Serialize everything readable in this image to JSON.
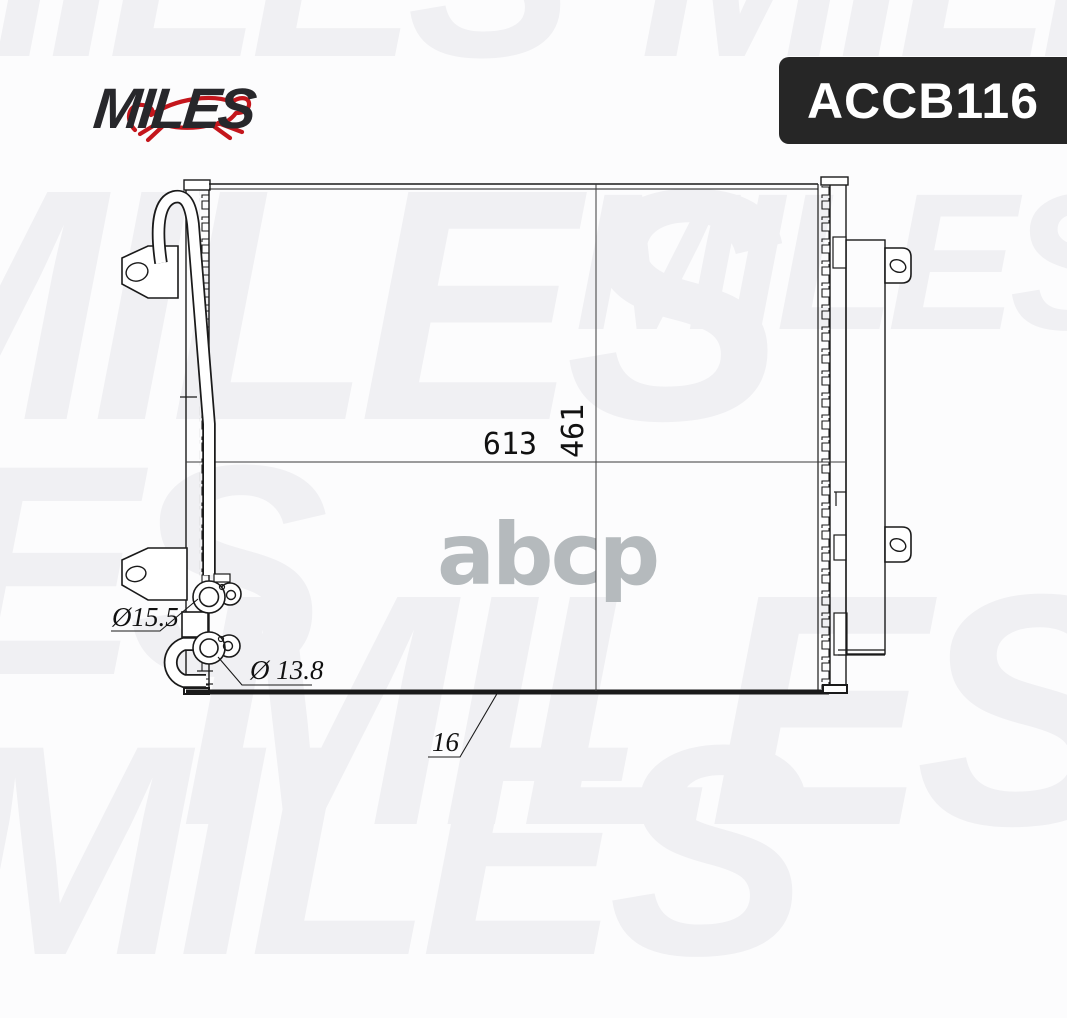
{
  "brand": {
    "logo_text": "MILES"
  },
  "part_number": "ACCB116",
  "watermark": {
    "tile_text": "MILES",
    "center_text": "abcp"
  },
  "drawing": {
    "title": "condenser-technical-drawing",
    "dim_width": "613",
    "dim_height": "461",
    "port_top_diameter": "Ø15.5",
    "port_bottom_diameter": "Ø 13.8",
    "core_thickness": "16"
  },
  "colors": {
    "brand_red": "#c4161c",
    "logo_dark": "#27272b",
    "badge_bg": "#262626",
    "badge_text": "#ffffff",
    "line_color": "#1a1a1a",
    "watermark_gray": "#f0f0f3",
    "abcp_gray": "#b5babd"
  }
}
